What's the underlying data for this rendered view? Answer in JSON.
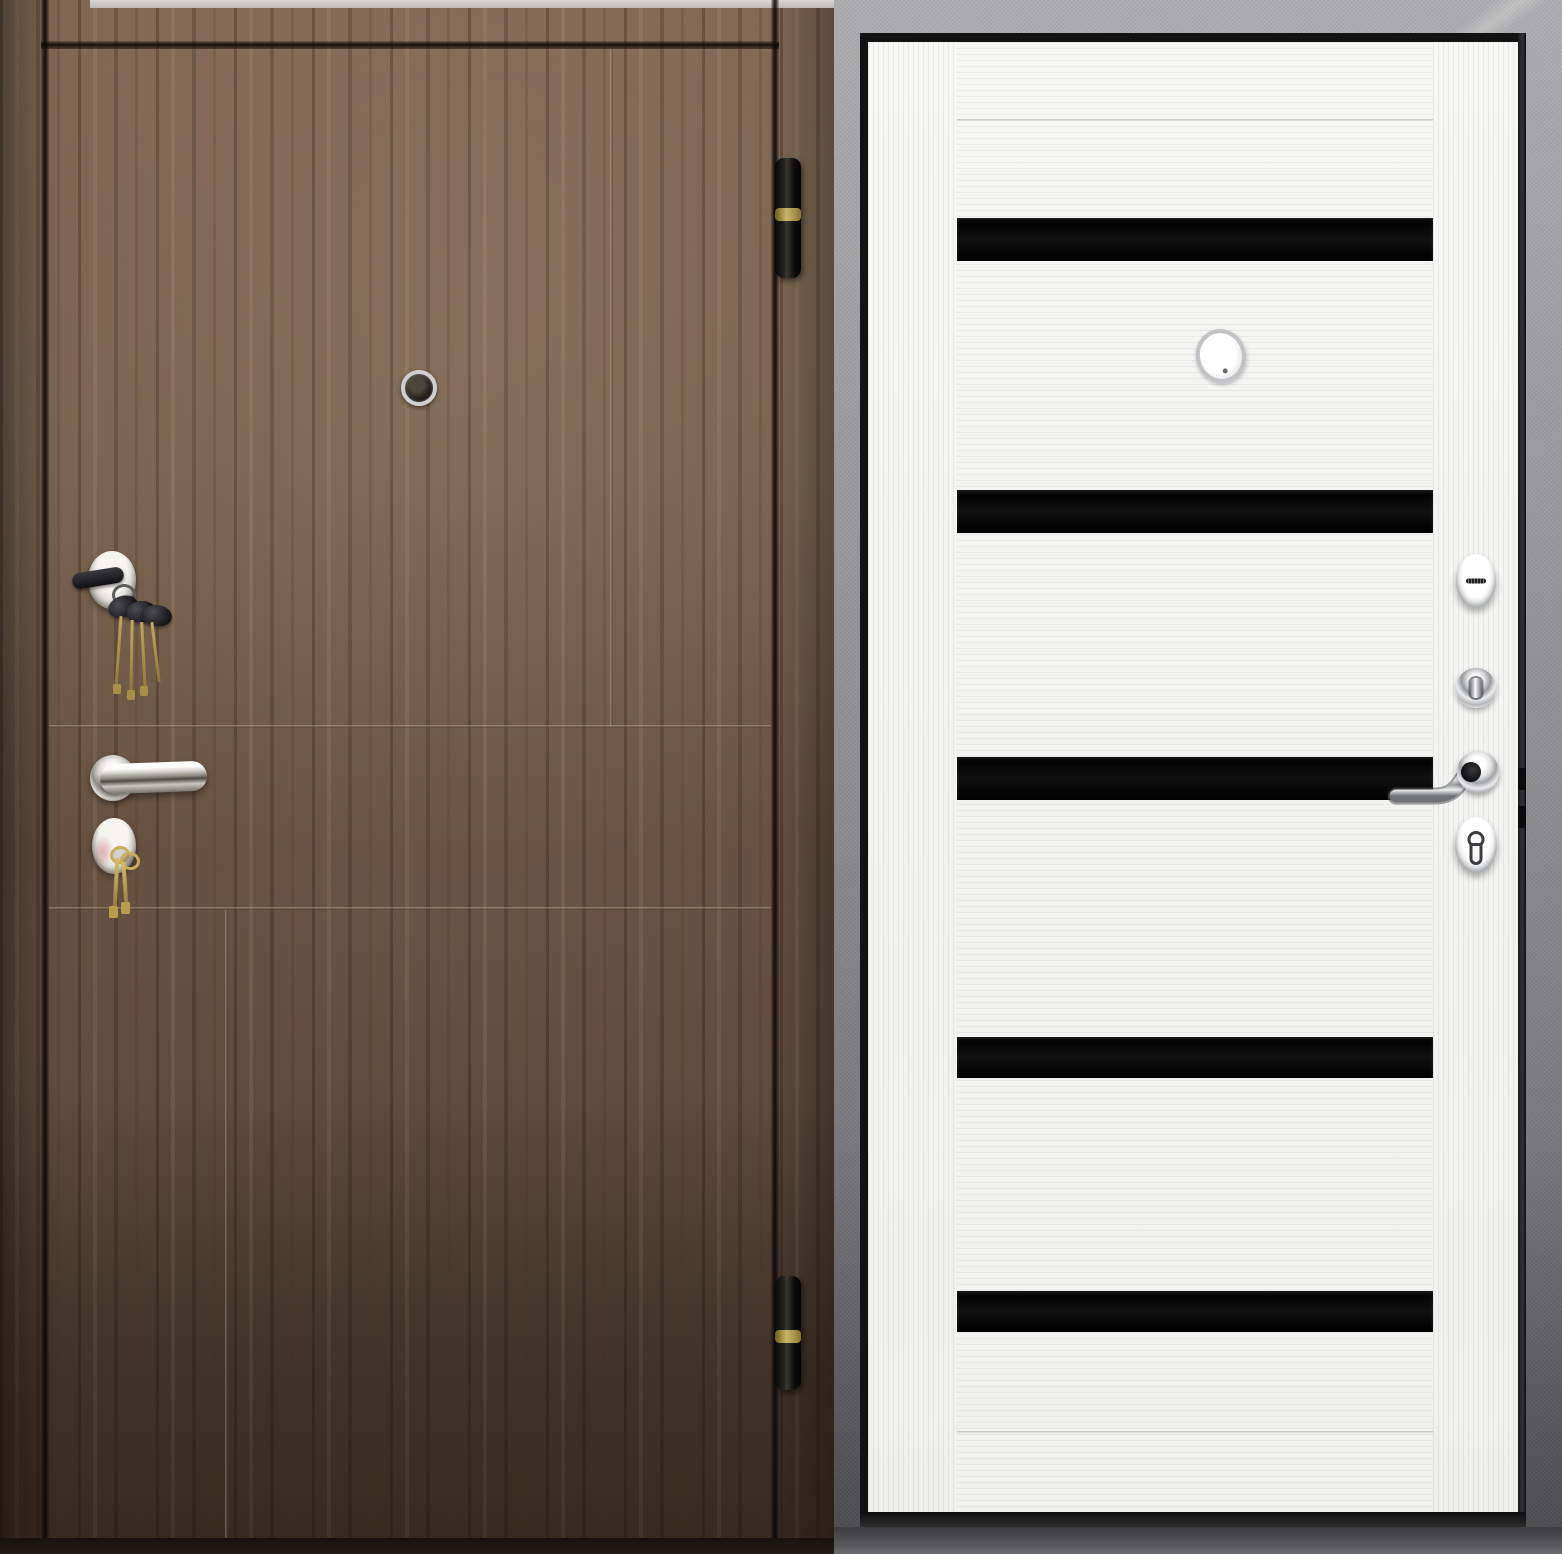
{
  "meta": {
    "kind": "product-photo",
    "subject": "Steel entry door shown from both sides: exterior in dark walnut wood, interior in white with black glass inserts",
    "width": 1562,
    "height": 1554
  },
  "palette": {
    "wood_brown": "#6b5442",
    "wood_shadow": "#443629",
    "glass_black": "#0b0b0b",
    "door_white": "#f4f4f2",
    "frame_gray": "#96969a",
    "chrome": "#d9dadd",
    "brass": "#b79a52"
  },
  "left_panel": {
    "label": "Exterior side: dark walnut door with milled grooves, peephole, two locks with keys, lever handle, two black hinges",
    "rect": {
      "x": 0,
      "y": 0,
      "w": 834,
      "h": 1554
    },
    "top_sliver": {
      "x": 90,
      "y": 0,
      "w": 744,
      "h": 8
    },
    "gap_left": {
      "x": 41,
      "y": 0,
      "w": 8,
      "h": 1554
    },
    "gap_top": {
      "x": 41,
      "y": 41,
      "w": 738,
      "h": 8
    },
    "gap_right": {
      "x": 771,
      "y": 0,
      "w": 8,
      "h": 1540
    },
    "grooves": {
      "v1": {
        "x": 610,
        "y": 49,
        "w": 3,
        "h": 678
      },
      "h1": {
        "x": 49,
        "y": 725,
        "w": 722,
        "h": 3
      },
      "h2": {
        "x": 49,
        "y": 907,
        "w": 722,
        "h": 3
      },
      "v2": {
        "x": 225,
        "y": 910,
        "w": 3,
        "h": 628
      }
    },
    "bottom_strip": {
      "x": 0,
      "y": 1538,
      "w": 834,
      "h": 16
    },
    "peephole": {
      "x": 401,
      "y": 370,
      "w": 28,
      "h": 28
    },
    "upper_lock": {
      "x": 88,
      "y": 551,
      "w": 48,
      "h": 58
    },
    "keyset_top": {
      "x": 84,
      "y": 558,
      "w": 100,
      "h": 150
    },
    "handle_rose": {
      "x": 90,
      "y": 755,
      "w": 46,
      "h": 46
    },
    "handle_lever": {
      "x": 100,
      "y": 764,
      "w": 107,
      "h": 30
    },
    "lower_lock": {
      "x": 92,
      "y": 818,
      "w": 44,
      "h": 56
    },
    "keyset_bottom": {
      "x": 96,
      "y": 842,
      "w": 50,
      "h": 78
    },
    "hinge_top": {
      "x": 775,
      "y": 158,
      "w": 26,
      "h": 120
    },
    "hinge_top_band": {
      "y": 50
    },
    "hinge_bottom": {
      "x": 775,
      "y": 1276,
      "w": 26,
      "h": 114
    },
    "hinge_bottom_band": {
      "y": 54
    }
  },
  "right_panel": {
    "label": "Interior side: white laminate door with five black glass stripes, chrome hardware, gray hammered steel frame",
    "rect": {
      "x": 834,
      "y": 0,
      "w": 728,
      "h": 1554
    },
    "frame_bottom": {
      "x": 0,
      "y": 1527,
      "w": 728,
      "h": 27
    },
    "black_edge_top": {
      "x": 26,
      "y": 33,
      "w": 666,
      "h": 9
    },
    "black_edge_left": {
      "x": 26,
      "y": 33,
      "w": 8,
      "h": 1494
    },
    "black_edge_right": {
      "x": 684,
      "y": 33,
      "w": 8,
      "h": 1494
    },
    "threshold": {
      "x": 26,
      "y": 1512,
      "w": 666,
      "h": 15
    },
    "leaf": {
      "x": 34,
      "y": 42,
      "w": 650,
      "h": 1470
    },
    "stile_left": {
      "x": 0,
      "y": 0,
      "w": 89,
      "h": 1470
    },
    "stile_right": {
      "x": 565,
      "y": 0,
      "w": 85,
      "h": 1470
    },
    "mainfield": {
      "x": 89,
      "y": 0,
      "w": 476,
      "h": 1470
    },
    "groove_top": {
      "x": 89,
      "y": 77,
      "w": 476,
      "h": 2
    },
    "groove_bottom": {
      "x": 89,
      "y": 1389,
      "w": 476,
      "h": 2
    },
    "stripes": [
      {
        "x": 89,
        "y": 176,
        "w": 476,
        "h": 43
      },
      {
        "x": 89,
        "y": 448,
        "w": 476,
        "h": 43
      },
      {
        "x": 89,
        "y": 715,
        "w": 476,
        "h": 43
      },
      {
        "x": 89,
        "y": 995,
        "w": 476,
        "h": 41
      },
      {
        "x": 89,
        "y": 1249,
        "w": 476,
        "h": 41
      }
    ],
    "peephole": {
      "x": 328,
      "y": 287,
      "w": 42,
      "h": 46
    },
    "esc_top": {
      "x": 588,
      "y": 512,
      "w": 40,
      "h": 54
    },
    "thumbturn": {
      "x": 588,
      "y": 626,
      "w": 40,
      "h": 40
    },
    "rose": {
      "x": 589,
      "y": 709,
      "w": 42,
      "h": 42
    },
    "lever": {
      "x": 514,
      "y": 714,
      "w": 100,
      "h": 52
    },
    "esc_cylinder": {
      "x": 587,
      "y": 775,
      "w": 42,
      "h": 56
    },
    "notch_latch": {
      "x": 684,
      "y": 768,
      "w": 8,
      "h": 22
    },
    "notch_bolt": {
      "x": 684,
      "y": 806,
      "w": 8,
      "h": 22
    }
  }
}
